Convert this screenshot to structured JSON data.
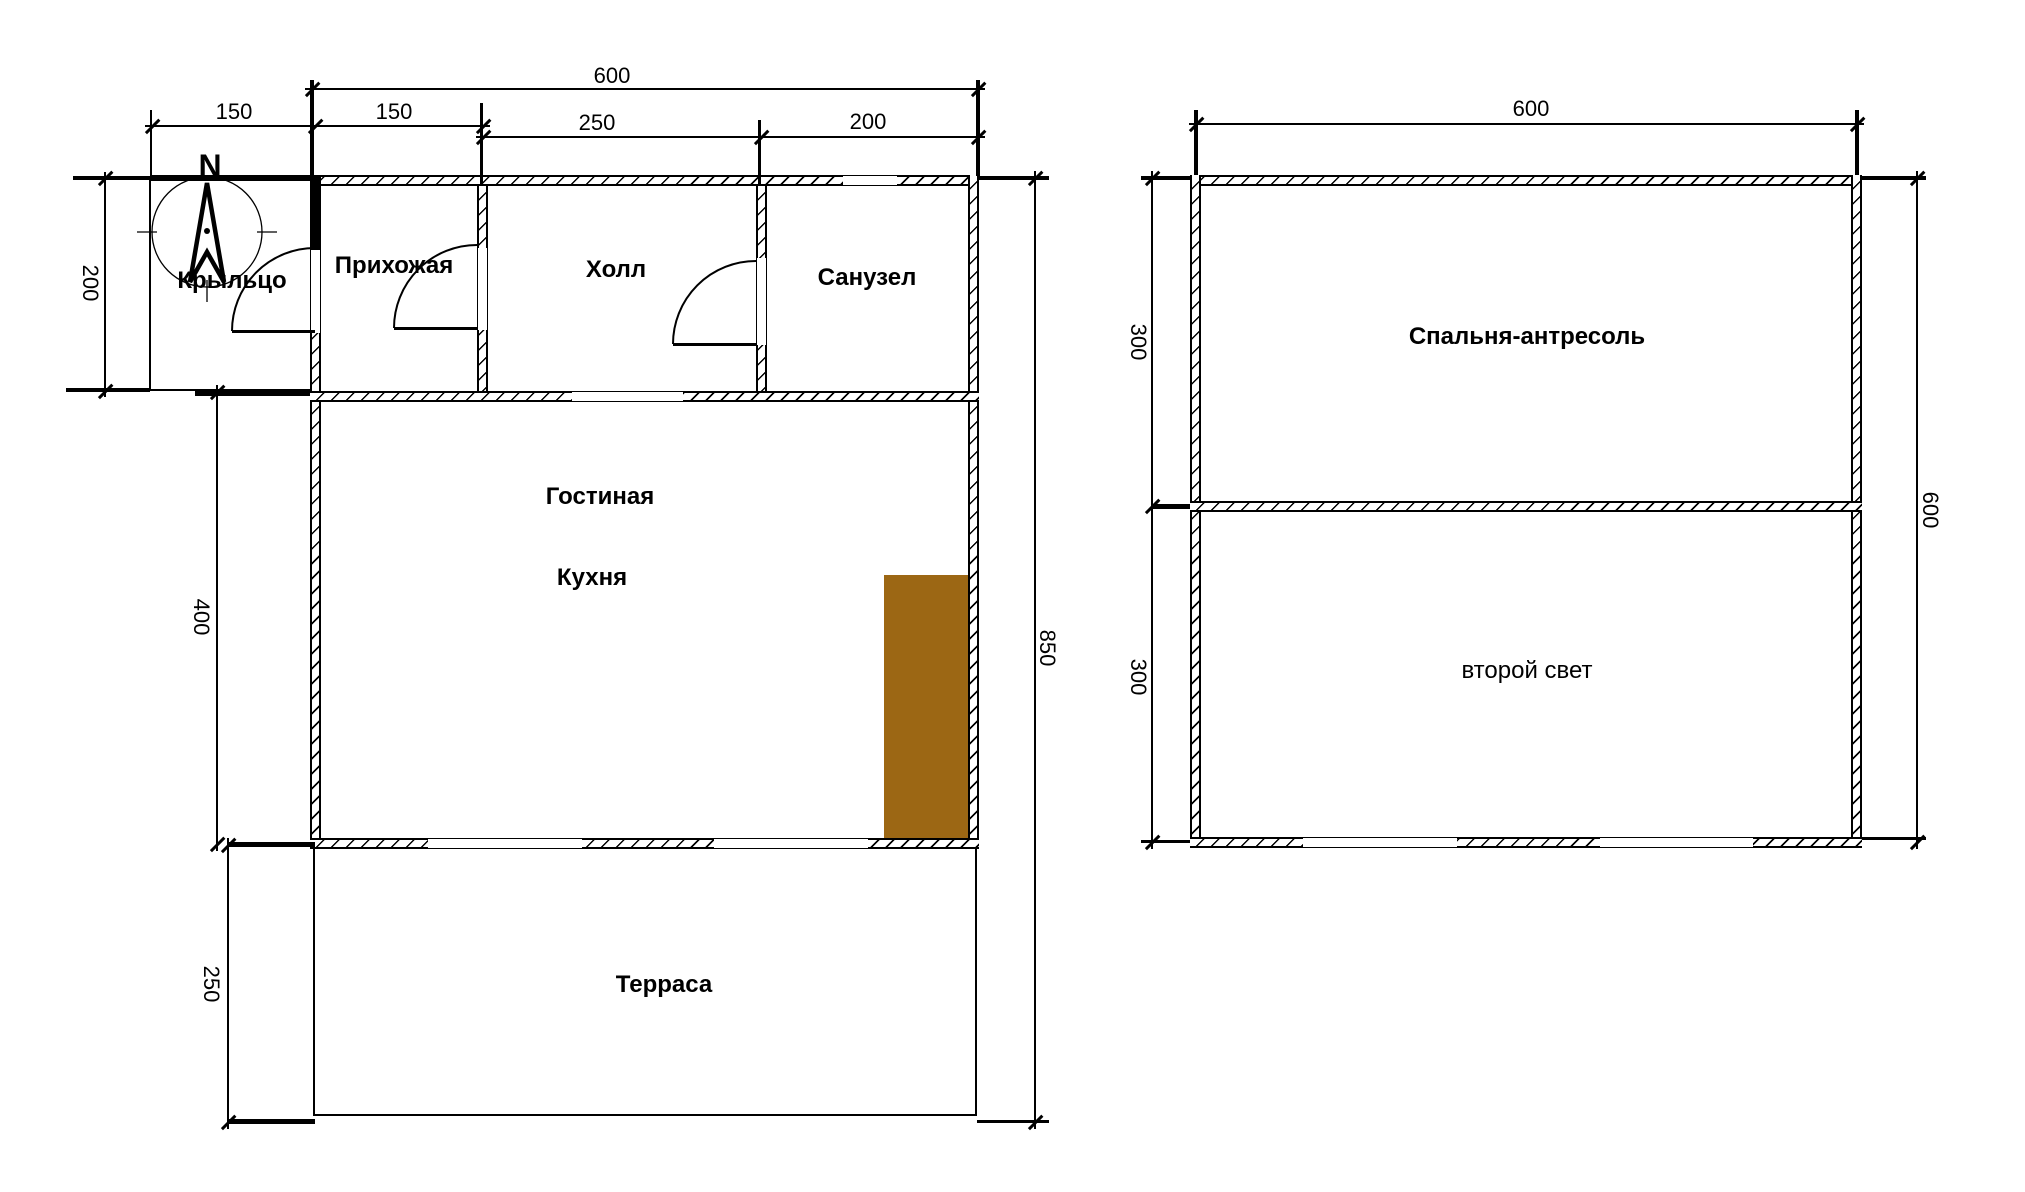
{
  "compass": {
    "north_label": "N"
  },
  "floor1": {
    "rooms": {
      "porch": "Крыльцо",
      "hallway": "Прихожая",
      "hall": "Холл",
      "bathroom": "Санузел",
      "living": "Гостиная",
      "kitchen": "Кухня",
      "terrace": "Терраса"
    },
    "dims": {
      "total_width": "600",
      "porch_width": "150",
      "hallway_width": "150",
      "hall_width": "250",
      "bathroom_width": "200",
      "top_row_height": "200",
      "living_height": "400",
      "terrace_height": "250",
      "total_height": "850"
    }
  },
  "floor2": {
    "rooms": {
      "bedroom": "Спальня-антресоль",
      "void": "второй свет"
    },
    "dims": {
      "total_width": "600",
      "total_height": "600",
      "upper_height": "300",
      "lower_height": "300"
    }
  },
  "colors": {
    "furniture": "#9c6714",
    "line": "#000000",
    "background": "#ffffff"
  }
}
